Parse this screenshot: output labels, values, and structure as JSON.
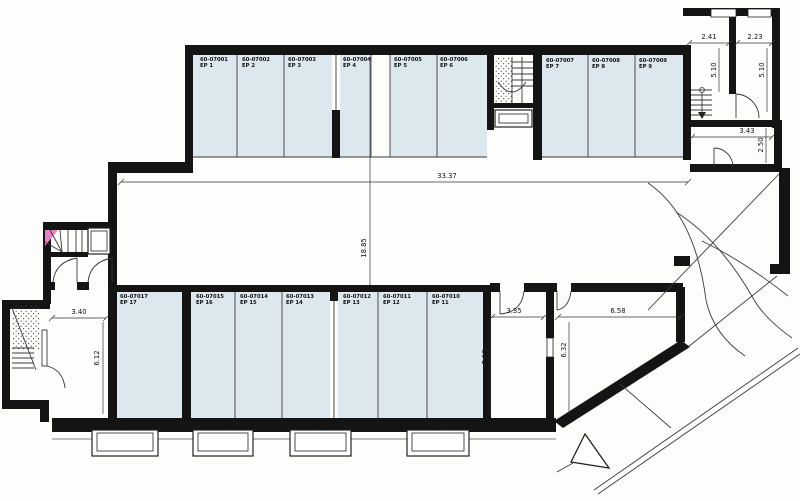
{
  "units_top": [
    {
      "code": "60-07001",
      "label": "EP 1"
    },
    {
      "code": "60-07002",
      "label": "EP 2"
    },
    {
      "code": "60-07003",
      "label": "EP 3"
    },
    {
      "code": "60-07004",
      "label": "EP 4"
    },
    {
      "code": "60-07005",
      "label": "EP 5"
    },
    {
      "code": "60-07006",
      "label": "EP 6"
    },
    {
      "code": "60-07007",
      "label": "EP 7"
    },
    {
      "code": "60-07008",
      "label": "EP 8"
    },
    {
      "code": "60-07009",
      "label": "EP 9"
    }
  ],
  "units_bottom": [
    {
      "code": "60-07017",
      "label": "EP 17"
    },
    {
      "code": "60-07015",
      "label": "EP 16"
    },
    {
      "code": "60-07014",
      "label": "EP 15"
    },
    {
      "code": "60-07013",
      "label": "EP 14"
    },
    {
      "code": "60-07012",
      "label": "EP 13"
    },
    {
      "code": "60-07011",
      "label": "EP 12"
    },
    {
      "code": "60-07010",
      "label": "EP 11"
    }
  ],
  "dimensions": {
    "aisle_width": "33.37",
    "aisle_depth": "18.85",
    "tr_room1_width": "2.41",
    "tr_room2_width": "2.23",
    "tr_room1_height": "5.10",
    "tr_room2_height": "5.10",
    "tr_lower_width": "3.43",
    "tr_lower_height": "2.50",
    "bl_room_width": "3.40",
    "bl_room_height": "6.12",
    "br_corridor_width": "3.35",
    "br_corridor_height": "7.18",
    "br_room_width": "6.58",
    "br_room_height": "6.32"
  },
  "colors": {
    "wall": "#141414",
    "unit_fill": "#dde8ee",
    "accent_pink": "#ea7fc3"
  }
}
